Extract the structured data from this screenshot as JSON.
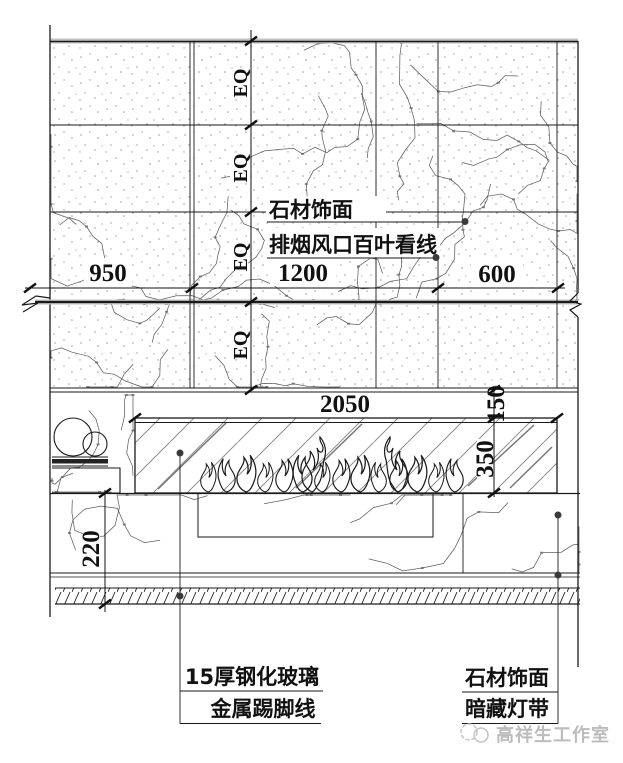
{
  "drawing_type": "fireplace-wall-elevation-detail",
  "dim": {
    "eq": "EQ",
    "d950": "950",
    "d1200": "1200",
    "d600": "600",
    "d2050": "2050",
    "d150": "150",
    "d350": "350",
    "d220": "220"
  },
  "labels": {
    "stone_top": "石材饰面",
    "louver": "排烟风口百叶看线",
    "glass": "15厚钢化玻璃",
    "skirting": "金属踢脚线",
    "stone_bottom": "石材饰面",
    "light_strip": "暗藏灯带"
  },
  "watermark": {
    "studio": "高祥生工作室"
  },
  "colors": {
    "line": "#1a1a1a",
    "heavy_gray": "#c2c2c2",
    "vein": "#5f5f5f",
    "watermark": "#bcbcbc"
  }
}
